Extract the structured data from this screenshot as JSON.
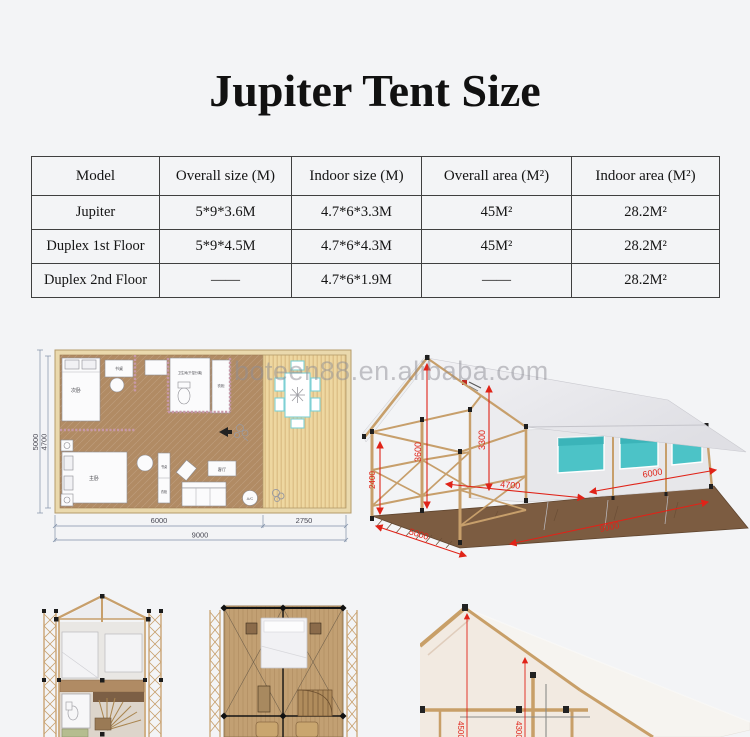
{
  "title": "Jupiter Tent Size",
  "size_table": {
    "headers": [
      "Model",
      "Overall size (M)",
      "Indoor size (M)",
      "Overall area (M²)",
      "Indoor area (M²)"
    ],
    "rows": [
      [
        "Jupiter",
        "5*9*3.6M",
        "4.7*6*3.3M",
        "45M²",
        "28.2M²"
      ],
      [
        "Duplex 1st Floor",
        "5*9*4.5M",
        "4.7*6*4.3M",
        "45M²",
        "28.2M²"
      ],
      [
        "Duplex 2nd Floor",
        "——",
        "4.7*6*1.9M",
        "——",
        "28.2M²"
      ]
    ]
  },
  "watermark": "boteen88.en.alibaba.com",
  "floor_plan": {
    "dim_width_outer": "5000",
    "dim_width_inner": "4700",
    "dim_length_interior": "6000",
    "dim_length_deck": "2750",
    "dim_length_total": "9000",
    "labels": {
      "bedroom2": "次卧",
      "desk1": "书桌",
      "bathroom": "卫生间(干湿分离)",
      "wardrobe1": "衣柜",
      "master": "主卧",
      "desk2": "书桌",
      "wardrobe2": "衣柜",
      "living": "客厅",
      "ac": "A/C"
    }
  },
  "tent_render": {
    "dim_ridge_height": "3600",
    "dim_indoor_height": "3300",
    "dim_porch_height": "2400",
    "dim_porch_width": "4700",
    "dim_indoor_length": "6000",
    "dim_width": "5000",
    "dim_length": "9000"
  },
  "section_view": {
    "dim_overall_height": "4500",
    "dim_indoor_height": "4300"
  },
  "colors": {
    "dimension_red": "#e02318",
    "window_teal": "#4cc3c7",
    "wood": "#c79f6b",
    "background": "#f3f4f6"
  }
}
